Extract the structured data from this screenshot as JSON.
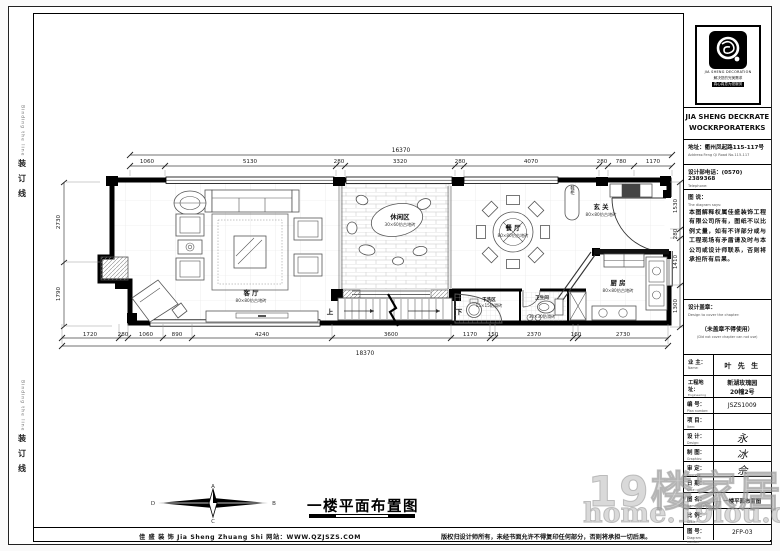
{
  "frame": {
    "binding_cn": "装订线",
    "binding_en": "Binding the line"
  },
  "footer": {
    "company": "佳 盛 装 饰  Jia Sheng Zhuang Shi    网站：WWW.QZJSZS.COM",
    "copyright": "版权归设计师所有，未经书面允许不得复印任何部分，否则将承担一切后果。"
  },
  "plan_title": {
    "text": "一楼平面布置图"
  },
  "compass": {
    "n": "A",
    "e": "B",
    "s": "C",
    "w": "D"
  },
  "watermark": {
    "line1": "19楼家居",
    "line2": "home.19lou.com"
  },
  "rooms": {
    "living": {
      "name": "客 厅",
      "tile": "80×80仿古地砖"
    },
    "leisure": {
      "name": "休闲区",
      "tile": "30×60仿古地砖"
    },
    "dining": {
      "name": "餐 厅",
      "tile": "80×80仿古地砖"
    },
    "entry": {
      "name": "玄 关",
      "tile": "80×80仿古地砖"
    },
    "kitchen": {
      "name": "厨 房",
      "tile": "80×80仿古地砖"
    },
    "wash": {
      "name": "干洗区",
      "tile": "15×15防滑砖"
    },
    "toilet": {
      "name": "卫生间",
      "tile": "30×30防滑砖"
    },
    "shoe_cabinet": "鞋柜",
    "stairs_up": "上",
    "stairs_down": "下"
  },
  "dims": {
    "top_total": "16370",
    "top": [
      "1060",
      "5130",
      "280",
      "3320",
      "280",
      "4070",
      "280",
      "780",
      "1170"
    ],
    "bottom": [
      "1720",
      "280",
      "1060",
      "890",
      "4240",
      "3600",
      "1170",
      "150",
      "2370",
      "160",
      "2730"
    ],
    "bottom_total": "18370",
    "left": [
      "2730",
      "1790"
    ],
    "right": [
      "1530",
      "280",
      "1410",
      "1300"
    ]
  },
  "titleblock": {
    "logo_en": "JIA SHENG DECORATION",
    "logo_slogan1": "解决您的完美需求",
    "logo_slogan2": "真心真意为您服务",
    "company_line1": "JIA SHENG DECKRATE",
    "company_line2": "WOCKRPORATERKS",
    "address_cn": "地址：衢州凤起路115-117号",
    "address_en": "Address:Feng Qi Road No.115-117",
    "phone_cn": "设计部电话：(0570) 2389368",
    "phone_en": "Telephone:",
    "says_cn": "图 说：",
    "says_en": "The diagram says:",
    "says_body": "本图解释权属佳盛装饰工程有限公司所有，图纸不以比例丈量，如有不详部分或与工程现场有矛盾请及时与本公司或设计师联系，否则将承担所有后果。",
    "seal_cn": "设计盖章：",
    "seal_en": "Design to cover the chapter:",
    "seal_note_cn": "（未盖章不得使用）",
    "seal_note_en": "(Did not cover chapter can not use)",
    "owner_label": "业 主：",
    "owner_en": "Name:",
    "owner_value": "叶 先 生",
    "site_label": "工程地址：",
    "site_en": "Engineering address:",
    "site_value1": "新湖玫瑰园",
    "site_value2": "20幢2号",
    "rows": [
      {
        "cn": "编 号：",
        "en": "Plan number:",
        "value": "JSZS1009"
      },
      {
        "cn": "项 目：",
        "en": "Item:",
        "value": ""
      },
      {
        "cn": "设 计：",
        "en": "Design:",
        "value": "永"
      },
      {
        "cn": "制 图：",
        "en": "Graphics:",
        "value": "冰"
      },
      {
        "cn": "审 定：",
        "en": "Approve:",
        "value": "佘"
      },
      {
        "cn": "日 期：",
        "en": "Date:",
        "value": ""
      },
      {
        "cn": "图 名：",
        "en": "Name for plan:",
        "value": "一楼平面布置图"
      },
      {
        "cn": "比 例：",
        "en": "Scale:",
        "value": ""
      },
      {
        "cn": "图 号：",
        "en": "Diagram number:",
        "value": "2FP-03"
      }
    ]
  }
}
